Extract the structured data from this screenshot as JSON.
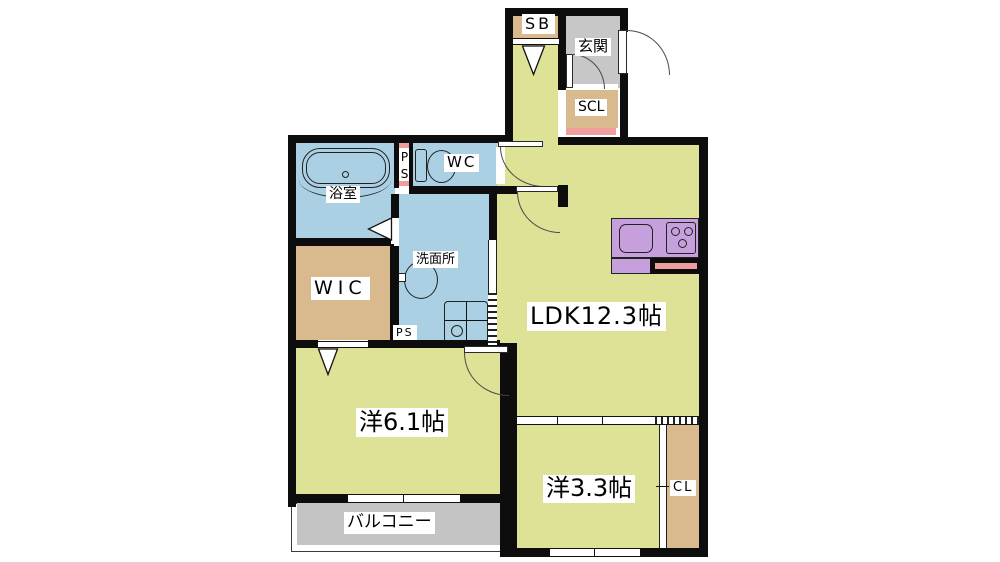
{
  "plan": {
    "rooms": {
      "sb": {
        "label": "SB"
      },
      "genkan": {
        "label": "玄関"
      },
      "scl": {
        "label": "SCL"
      },
      "bathroom": {
        "label": "浴室"
      },
      "ps_upper": {
        "label": "PS"
      },
      "wc": {
        "label": "WC"
      },
      "washroom": {
        "label": "洗面所"
      },
      "wic": {
        "label": "WIC"
      },
      "ps_lower": {
        "label": "PS"
      },
      "ldk": {
        "label": "LDK12.3帖"
      },
      "bedroom_61": {
        "label": "洋6.1帖"
      },
      "bedroom_33": {
        "label": "洋3.3帖"
      },
      "cl": {
        "label": "CL"
      },
      "balcony": {
        "label": "バルコニー"
      }
    },
    "colors": {
      "wall": "#0d0d0d",
      "room_yellow": "#dde296",
      "wet_blue": "#abd0e4",
      "closet_tan": "#d9ba8e",
      "entrance_gray": "#c7c7c7",
      "balcony_gray": "#c4c4c4",
      "kitchen_purple": "#c6a0dc",
      "accent_pink": "#ef9d9d",
      "label_bg": "#ffffff"
    }
  }
}
